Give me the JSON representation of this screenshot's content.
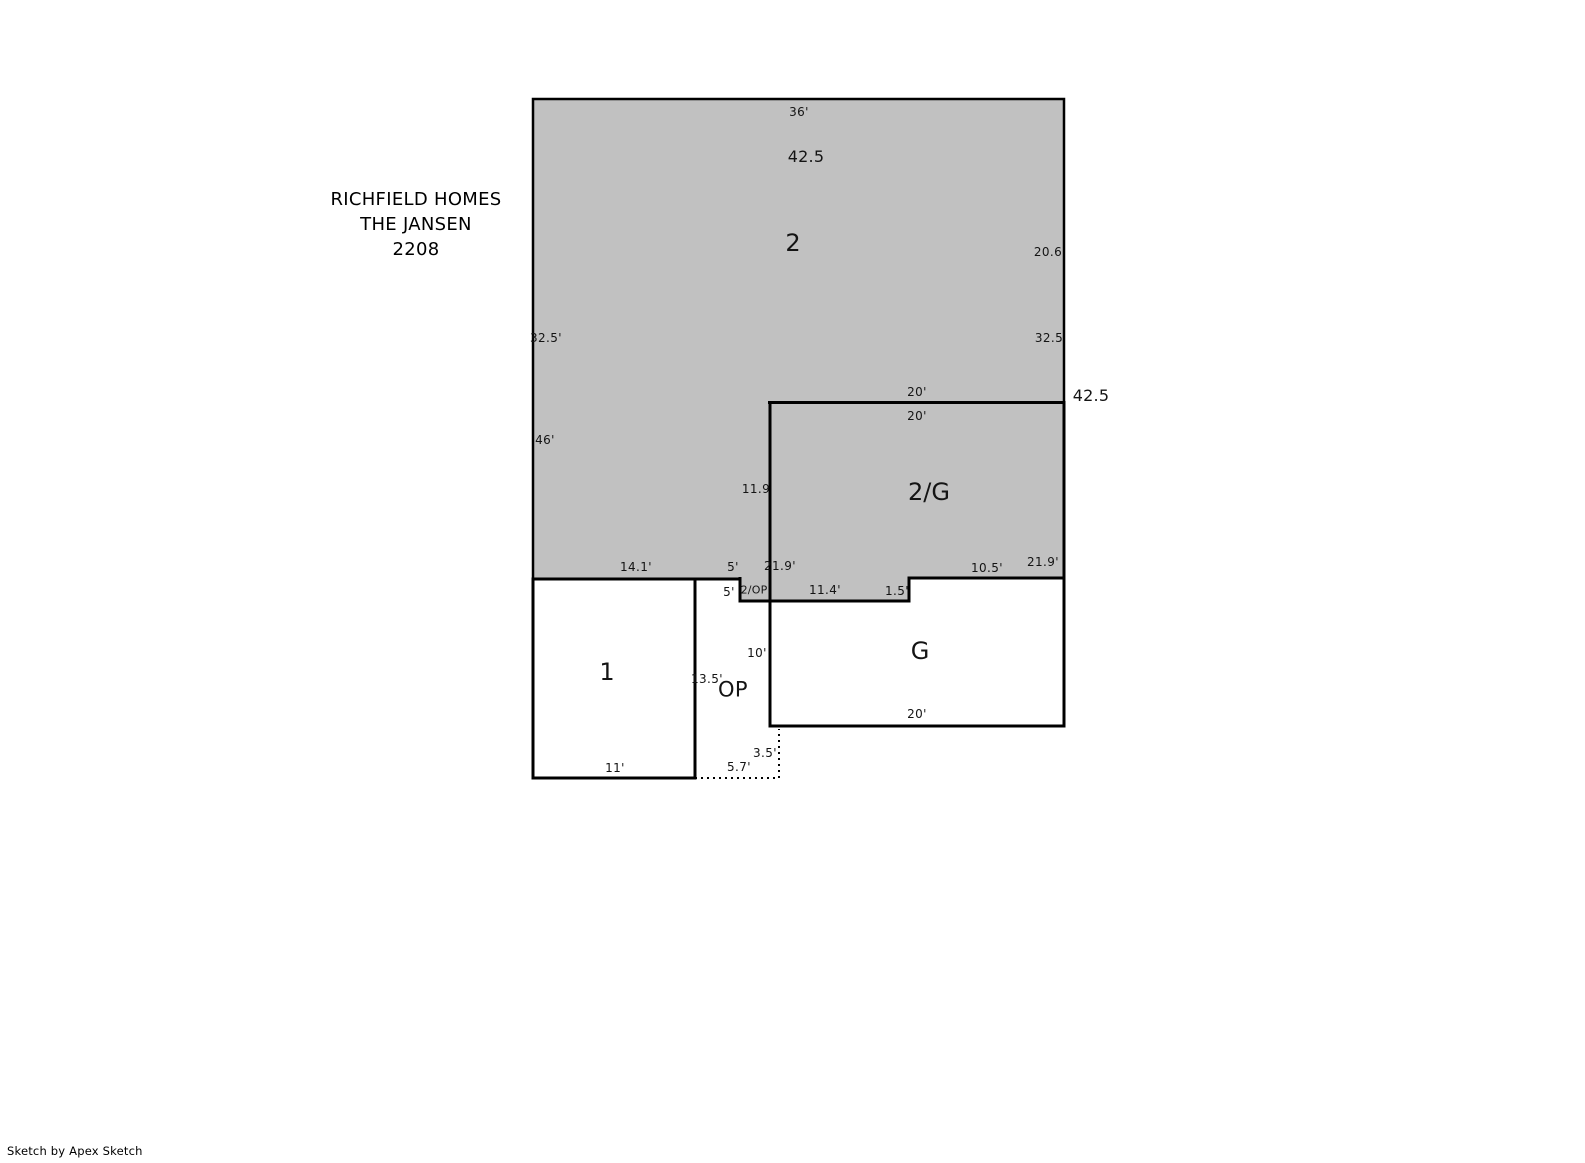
{
  "title": {
    "line1": "RICHFIELD HOMES",
    "line2": "THE JANSEN",
    "line3": "2208"
  },
  "credit": "Sketch by Apex Sketch",
  "colors": {
    "area_fill": "#c1c1c1",
    "wall": "#000000",
    "background": "#ffffff"
  },
  "areas": {
    "second_floor_label": "2",
    "second_over_garage_label": "2/G",
    "first_floor_label": "1",
    "garage_label": "G",
    "open_porch_label": "OP",
    "second_over_porch_label": "2/OP"
  },
  "dims": [
    {
      "name": "top-width",
      "text": "36'"
    },
    {
      "name": "overall-width-upper",
      "text": "42.5"
    },
    {
      "name": "right-wall-upper",
      "text": "20.6"
    },
    {
      "name": "left-wall-upper",
      "text": "32.5'"
    },
    {
      "name": "right-wall-mid",
      "text": "32.5"
    },
    {
      "name": "garage-top-outside",
      "text": "20'"
    },
    {
      "name": "overall-right",
      "text": "42.5"
    },
    {
      "name": "garage-top-inside",
      "text": "20'"
    },
    {
      "name": "left-wall-lower",
      "text": "46'"
    },
    {
      "name": "two-g-left-wall",
      "text": "11.9"
    },
    {
      "name": "bottom-left-segment",
      "text": "14.1'"
    },
    {
      "name": "bottom-five-upper",
      "text": "5'"
    },
    {
      "name": "two-g-left-height",
      "text": "21.9'"
    },
    {
      "name": "garage-top-right-segment",
      "text": "10.5'"
    },
    {
      "name": "two-g-right-height",
      "text": "21.9'"
    },
    {
      "name": "bottom-five-lower",
      "text": "5'"
    },
    {
      "name": "strip-width",
      "text": "11.4'"
    },
    {
      "name": "strip-step",
      "text": "1.5'"
    },
    {
      "name": "porch-right-height",
      "text": "10'"
    },
    {
      "name": "first-floor-right-height",
      "text": "13.5'"
    },
    {
      "name": "garage-bottom-width",
      "text": "20'"
    },
    {
      "name": "porch-step-height",
      "text": "3.5'"
    },
    {
      "name": "porch-bottom-width",
      "text": "5.7'"
    },
    {
      "name": "first-floor-bottom-width",
      "text": "11'"
    }
  ]
}
